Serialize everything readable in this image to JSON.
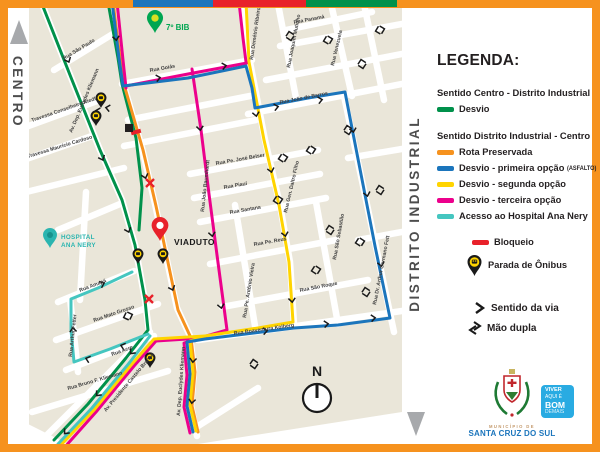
{
  "palette": {
    "green": "#00914B",
    "orange": "#F6921E",
    "blue": "#1B75BC",
    "yellow": "#FFD400",
    "pink": "#EC008C",
    "teal": "#45C6C0",
    "red": "#E8212A",
    "border": "#F6921E"
  },
  "frame": {
    "top_bar": [
      "#1B75BC",
      "#E8212A",
      "#00914B"
    ]
  },
  "side_labels": {
    "left": "CENTRO",
    "right": "DISTRITO INDUSTRIAL"
  },
  "legend": {
    "title": "LEGENDA:",
    "section1": {
      "heading": "Sentido Centro - Distrito Industrial",
      "item": {
        "color": "#00914B",
        "label": "Desvio"
      }
    },
    "section2": {
      "heading": "Sentido Distrito Industrial - Centro",
      "items": [
        {
          "color": "#F6921E",
          "label": "Rota Preservada"
        },
        {
          "color": "#1B75BC",
          "label": "Desvio - primeira opção",
          "tag": "(ASFALTO)"
        },
        {
          "color": "#FFD400",
          "label": "Desvio - segunda opção"
        },
        {
          "color": "#EC008C",
          "label": "Desvio - terceira opção"
        },
        {
          "color": "#45C6C0",
          "label": "Acesso ao Hospital Ana Nery"
        }
      ]
    },
    "bloqueio": {
      "color": "#E8212A",
      "label": "Bloqueio"
    },
    "parada": {
      "label": "Parada de Ônibus"
    },
    "sentido": {
      "label": "Sentido da via"
    },
    "mao_dupla": {
      "label": "Mão dupla"
    }
  },
  "footer": {
    "municipio_line1": "MUNICÍPIO DE",
    "municipio_line2": "SANTA CRUZ DO SUL",
    "badge_color": "#29ABE2",
    "badge": [
      "VIVER",
      "AQUI É",
      "BOM",
      "DEMAIS"
    ]
  },
  "map": {
    "pois": {
      "bib": "7º BIB",
      "hospital_line1": "HOSPITAL",
      "hospital_line2": "ANA NERY",
      "viaduto": "VIADUTO",
      "compass": "N"
    },
    "streets": [
      "Rua São Paulo",
      "Av. Dep. Euclydes Kliemann",
      "Travessa Conselheiro Riedl",
      "Travessa Maurício Cardoso",
      "Rua Goiás",
      "Rua Demétrio Ribeiro",
      "Rua Joaquim Mutinho",
      "Rua Panamá",
      "Rua Venezuela",
      "Rua João de Barros",
      "Rua Pe. José Belser",
      "Rua Piauí",
      "Rua Santana",
      "Rua João Baumhardt",
      "Rua Gen. Daltro Filho",
      "Rua Pe. Antônio Vieira",
      "Rua Pe. Reus",
      "Rua São Roque",
      "Rua São Sebastião",
      "Rua Dr. Arthur Germano Fett",
      "Rua Boaventura Kolberg",
      "Rua Amapá",
      "Rua Mato Grosso",
      "Rua Acre",
      "Rua Arthur Fetter",
      "Rua Bruno F. Kliemann",
      "Av. Presidente Castelo Branco",
      "Av. Dep. Euclydes Kliemann"
    ]
  }
}
